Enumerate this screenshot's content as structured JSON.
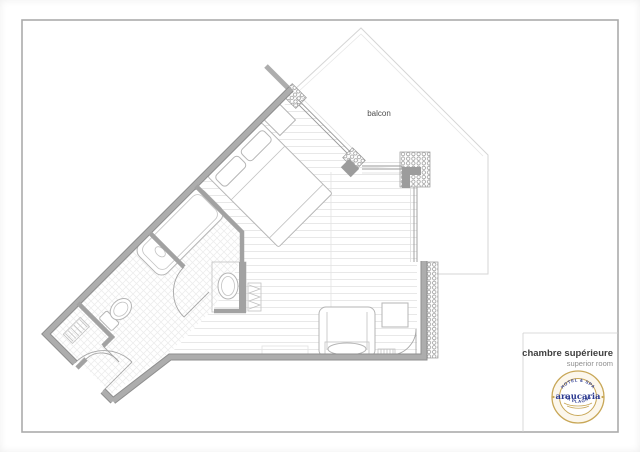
{
  "plan": {
    "balcony_label": "balcon"
  },
  "title_block": {
    "title": "chambre supérieure",
    "subtitle": "superior room"
  },
  "logo": {
    "top_text": "HOTEL & SPA",
    "name": "araucaria",
    "bottom_text": "LA PLAGNE"
  },
  "colors": {
    "wall_gray": "#9c9c9c",
    "partition_gray": "#a2a2a2",
    "furniture_line": "#b5b5b5",
    "balcony_line": "#d6d6d6",
    "floor_line": "#e8e8e8",
    "logo_gold": "#c8a757",
    "logo_navy": "#2b3990",
    "title_text": "#3f3f3f",
    "subtitle_text": "#8f8f8f"
  }
}
